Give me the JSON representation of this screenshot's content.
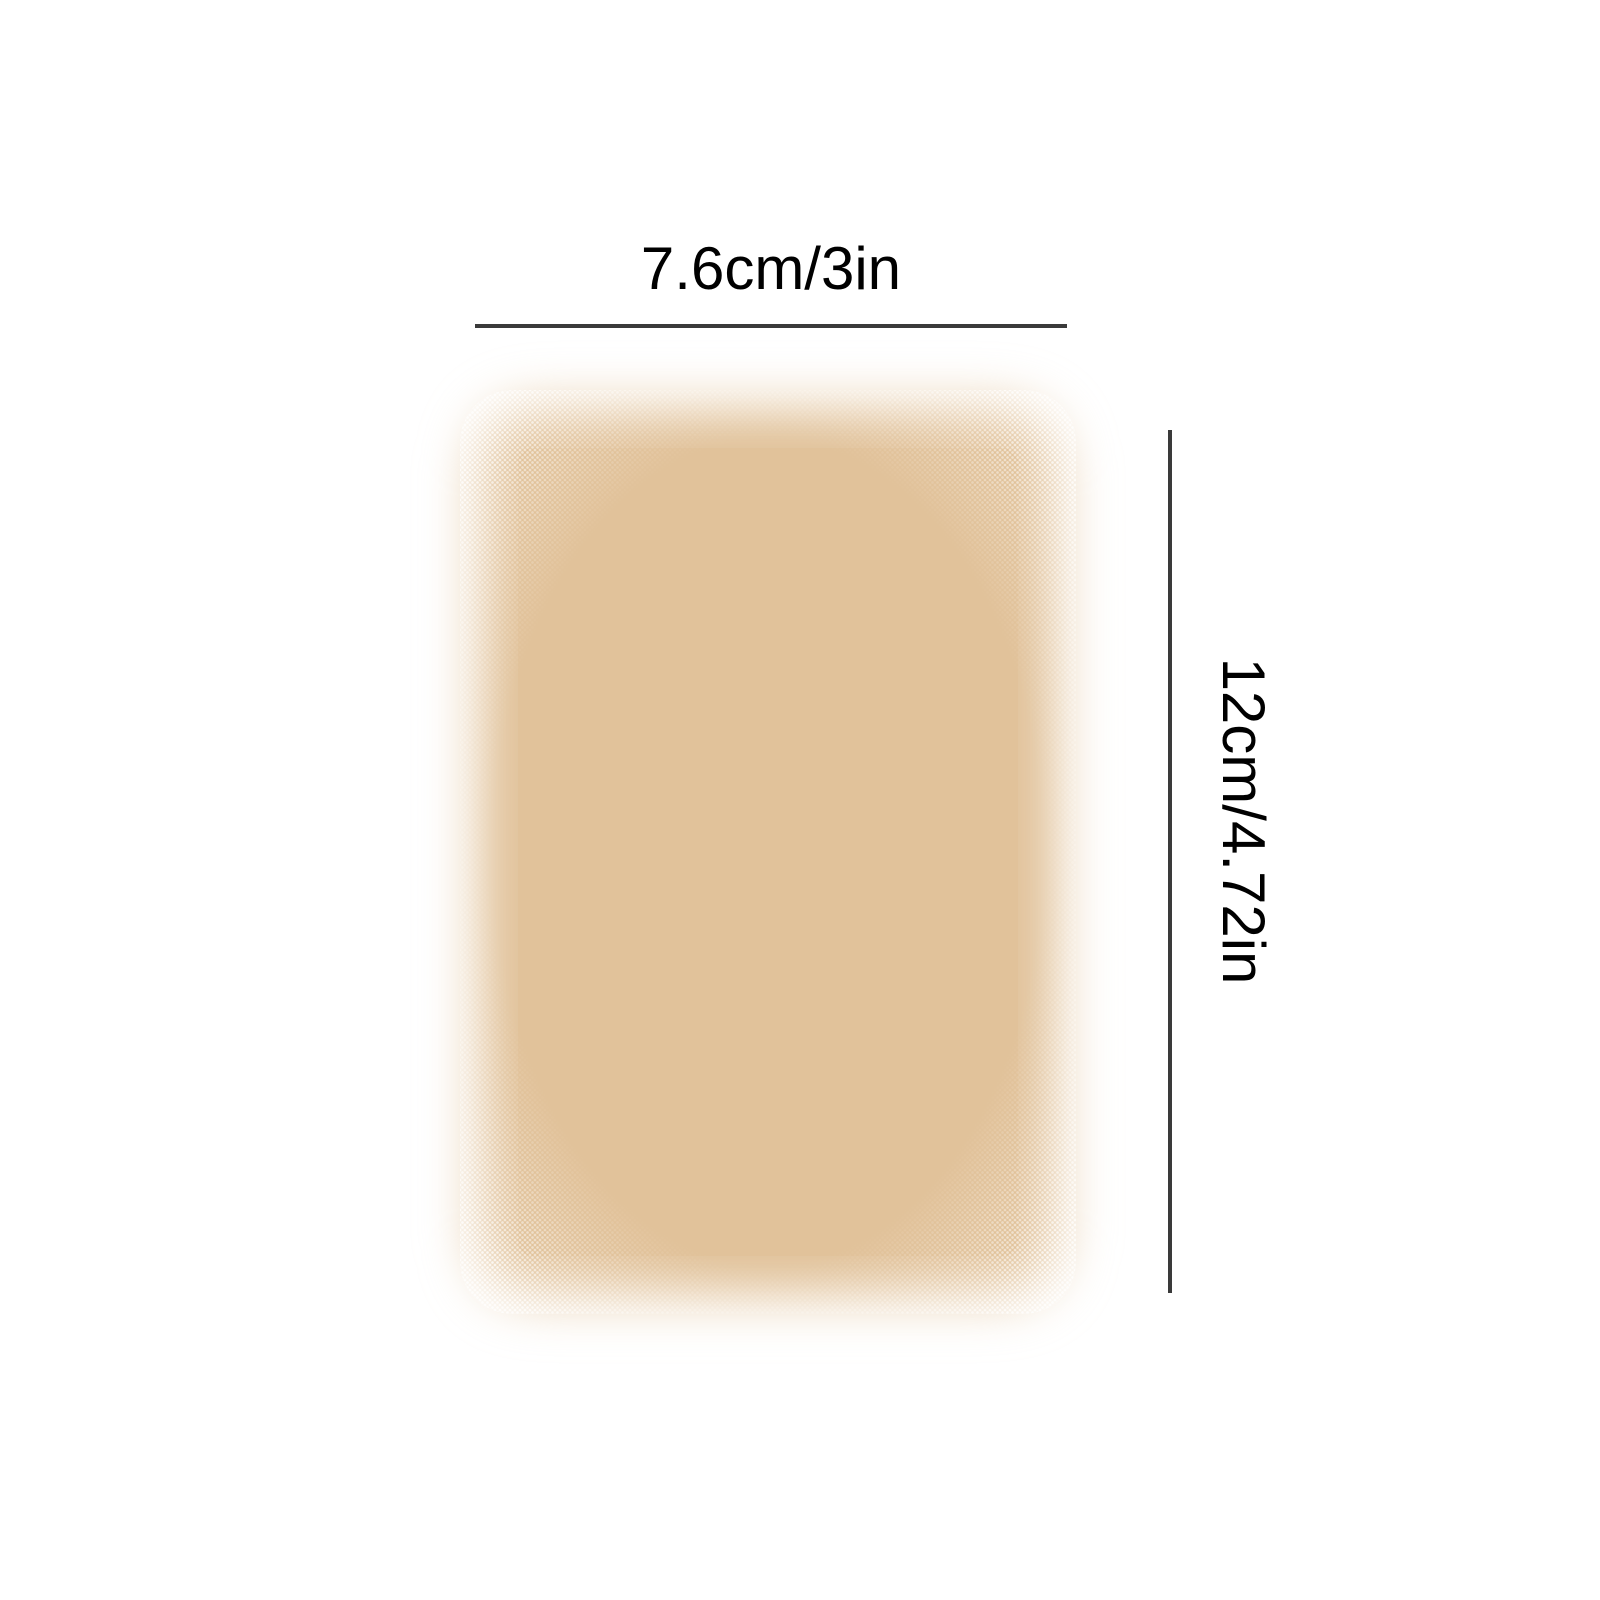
{
  "diagram": {
    "subject": "rectangular adhesive patch with feathered halftone edges",
    "dimensions": {
      "width_label": "7.6cm/3in",
      "height_label": "12cm/4.72in"
    }
  },
  "colors": {
    "patch": "#e1c29a",
    "line": "#3a3a3a",
    "text": "#000000",
    "background": "#ffffff"
  }
}
